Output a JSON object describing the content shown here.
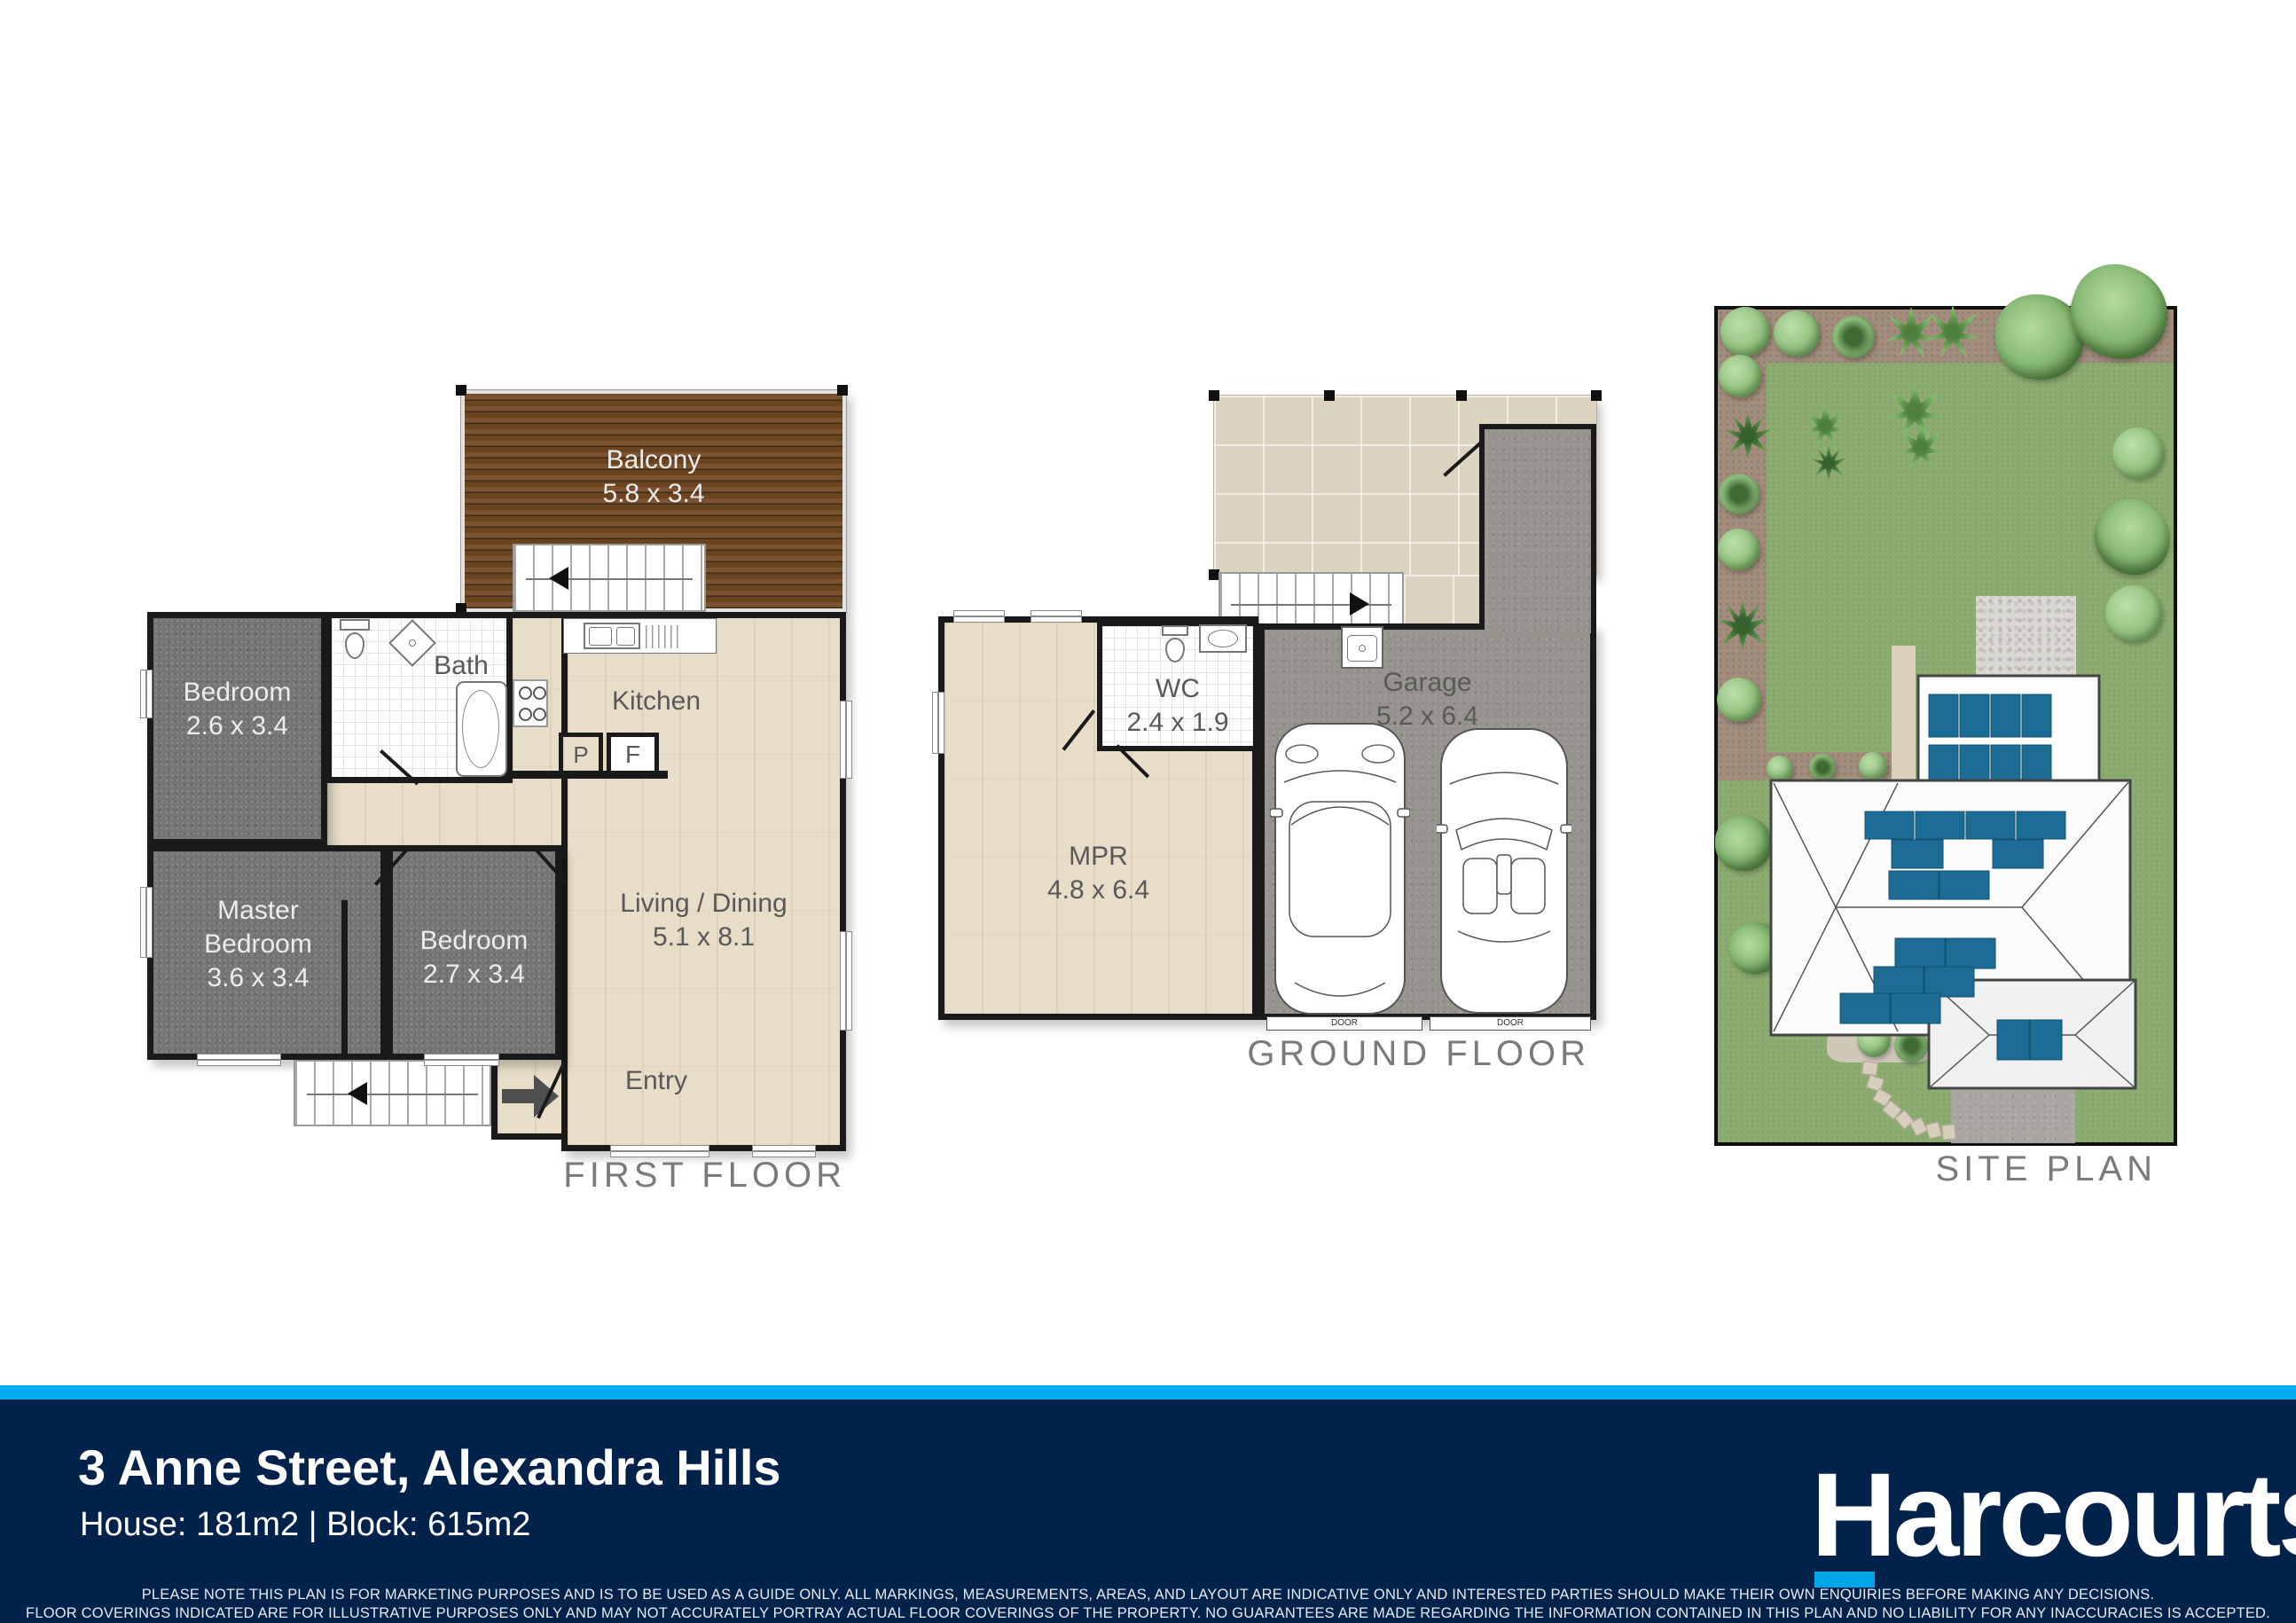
{
  "first_floor": {
    "title": "FIRST FLOOR",
    "rooms": {
      "balcony": {
        "name": "Balcony",
        "dims": "5.8 x 3.4"
      },
      "bedroom1": {
        "name": "Bedroom",
        "dims": "2.6 x 3.4"
      },
      "bath": {
        "name": "Bath"
      },
      "kitchen": {
        "name": "Kitchen"
      },
      "pantry": {
        "label": "P"
      },
      "fridge": {
        "label": "F"
      },
      "living": {
        "name": "Living / Dining",
        "dims": "5.1 x 8.1"
      },
      "master": {
        "name_line1": "Master",
        "name_line2": "Bedroom",
        "dims": "3.6 x 3.4"
      },
      "bedroom2": {
        "name": "Bedroom",
        "dims": "2.7 x 3.4"
      },
      "entry": {
        "name": "Entry"
      }
    }
  },
  "ground_floor": {
    "title": "GROUND FLOOR",
    "rooms": {
      "wc": {
        "name": "WC",
        "dims": "2.4 x 1.9"
      },
      "mpr": {
        "name": "MPR",
        "dims": "4.8 x 6.4"
      },
      "garage": {
        "name": "Garage",
        "dims": "5.2 x 6.4",
        "door_label": "DOOR"
      }
    }
  },
  "site_plan": {
    "title": "SITE PLAN"
  },
  "footer": {
    "address": "3 Anne Street, Alexandra Hills",
    "details": "House: 181m2 |  Block: 615m2",
    "brand": "Harcourts",
    "disclaimer_line1": "PLEASE NOTE THIS PLAN IS FOR MARKETING PURPOSES AND IS TO BE USED AS A GUIDE ONLY.  ALL MARKINGS, MEASUREMENTS, AREAS, AND LAYOUT ARE INDICATIVE ONLY AND INTERESTED PARTIES SHOULD MAKE THEIR OWN ENQUIRIES BEFORE MAKING ANY DECISIONS.",
    "disclaimer_line2": "FLOOR COVERINGS INDICATED ARE FOR ILLUSTRATIVE PURPOSES ONLY AND MAY NOT ACCURATELY PORTRAY ACTUAL FLOOR COVERINGS OF THE PROPERTY.  NO GUARANTEES ARE MADE REGARDING THE INFORMATION CONTAINED IN THIS PLAN AND NO LIABILITY FOR  ANY INACCURACIES IS ACCEPTED."
  },
  "colors": {
    "accent_blue": "#00AEEF",
    "navy": "#01224B",
    "solar_panel": "#1C6C96",
    "grass": "#8DAC71"
  }
}
